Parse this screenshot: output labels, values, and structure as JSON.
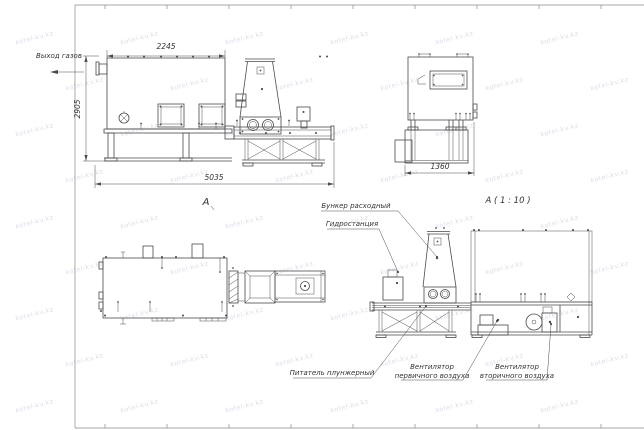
{
  "watermark": {
    "text": "kotel-kv.kz"
  },
  "labels": {
    "gas_outlet": "Выход газов",
    "section_a": "А",
    "detail_title": "А ( 1 : 10 )",
    "feed_hopper": "Бункер расходный",
    "hydraulic_station": "Гидростанция",
    "plunger_feeder": "Питатель плунжерный",
    "primary_fan_line1": "Вентилятор",
    "primary_fan_line2": "первичного воздуха",
    "secondary_fan_line1": "Вентилятор",
    "secondary_fan_line2": "вторичного воздуха"
  },
  "dimensions": {
    "top_width": "2245",
    "left_height": "2905",
    "total_length": "5035",
    "front_width": "1360"
  },
  "colors": {
    "line": "#4a4a4a",
    "text": "#333333",
    "frame": "#8a8a8a",
    "watermark": "rgba(139,155,178,0.33)",
    "background": "#ffffff"
  }
}
